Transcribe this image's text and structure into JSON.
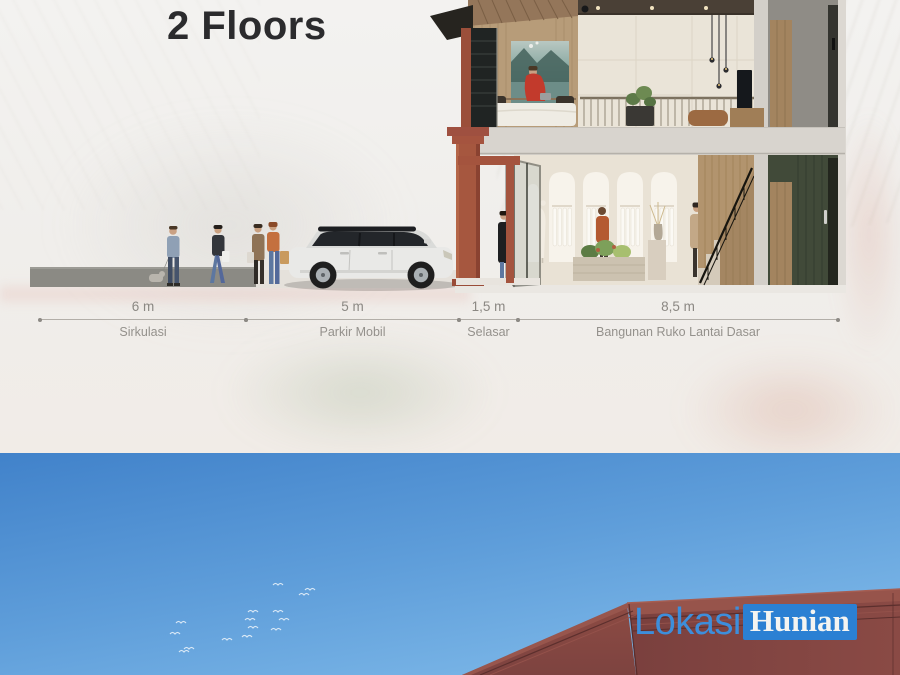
{
  "header": {
    "title": "2 Floors"
  },
  "section_diagram": {
    "dimensions": [
      {
        "value": "6 m",
        "label": "Sirkulasi"
      },
      {
        "value": "5 m",
        "label": "Parkir Mobil"
      },
      {
        "value": "1,5 m",
        "label": "Selasar"
      },
      {
        "value": "8,5 m",
        "label": "Bangunan Ruko Lantai Dasar"
      }
    ]
  },
  "watermark": {
    "lokasi": "Lokasi",
    "hunian": "Hunian"
  },
  "colors": {
    "title_text": "#2b2b2d",
    "dimension_text": "#8b8883",
    "dimension_line": "#b2aea8",
    "sky_top": "#4182ca",
    "sky_bottom": "#85bfec",
    "maroon_building": "#7c4240",
    "brick_column": "#a6573f",
    "watermark_box_blue": "#2b80d3",
    "watermark_text_blue": "#3d8edb"
  },
  "icons": {
    "bird_icon": "white double-arc (∿) flying-bird glyph",
    "dimension_dot_icon": "small gray endpoint dot on dimension line"
  }
}
